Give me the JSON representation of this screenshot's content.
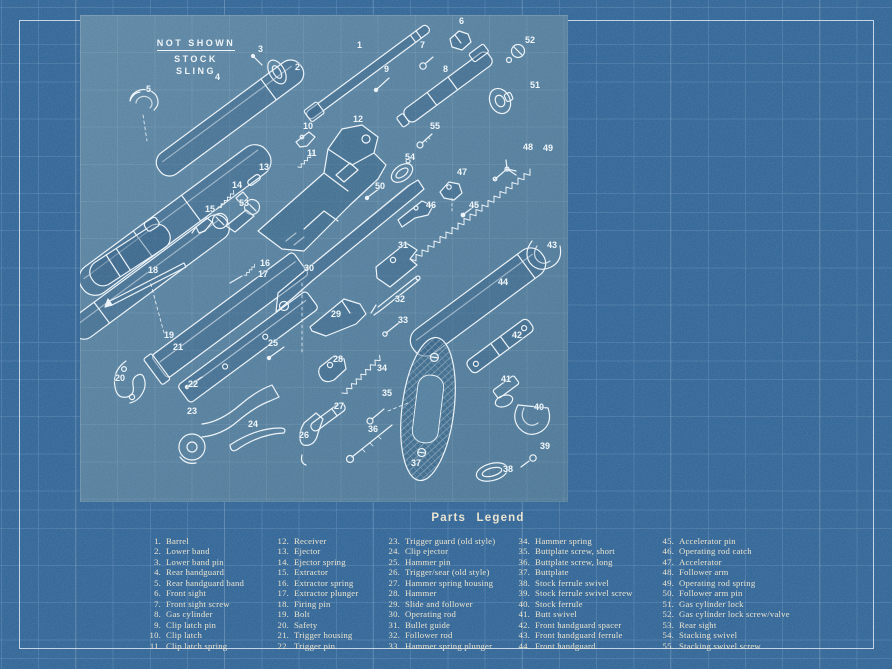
{
  "colors": {
    "background": "#2d6294",
    "panel": "#4f7c9c",
    "panel-shade": "#3c6e93",
    "ink": "#eae3cc",
    "line": "#ecf3f8",
    "frame": "#dce8f0"
  },
  "not_shown": {
    "heading": "NOT SHOWN",
    "line1": "STOCK",
    "line2": "SLING"
  },
  "legend": {
    "title": "Parts Legend",
    "items": [
      {
        "num": "1.",
        "name": "Barrel"
      },
      {
        "num": "2.",
        "name": "Lower band"
      },
      {
        "num": "3.",
        "name": "Lower band pin"
      },
      {
        "num": "4.",
        "name": "Rear handguard"
      },
      {
        "num": "5.",
        "name": "Rear handguard band"
      },
      {
        "num": "6.",
        "name": "Front sight"
      },
      {
        "num": "7.",
        "name": "Front sight screw"
      },
      {
        "num": "8.",
        "name": "Gas cylinder"
      },
      {
        "num": "9.",
        "name": "Clip latch pin"
      },
      {
        "num": "10.",
        "name": "Clip latch"
      },
      {
        "num": "11.",
        "name": "Clip latch spring"
      },
      {
        "num": "12.",
        "name": "Receiver"
      },
      {
        "num": "13.",
        "name": "Ejector"
      },
      {
        "num": "14.",
        "name": "Ejector spring"
      },
      {
        "num": "15.",
        "name": "Extractor"
      },
      {
        "num": "16.",
        "name": "Extractor spring"
      },
      {
        "num": "17.",
        "name": "Extractor plunger"
      },
      {
        "num": "18.",
        "name": "Firing pin"
      },
      {
        "num": "19.",
        "name": "Bolt"
      },
      {
        "num": "20.",
        "name": "Safety"
      },
      {
        "num": "21.",
        "name": "Trigger housing"
      },
      {
        "num": "22.",
        "name": "Trigger pin"
      },
      {
        "num": "23.",
        "name": "Trigger guard (old style)"
      },
      {
        "num": "24.",
        "name": "Clip ejector"
      },
      {
        "num": "25.",
        "name": "Hammer pin"
      },
      {
        "num": "26.",
        "name": "Trigger/sear (old style)"
      },
      {
        "num": "27.",
        "name": "Hammer spring housing"
      },
      {
        "num": "28.",
        "name": "Hammer"
      },
      {
        "num": "29.",
        "name": "Slide and follower"
      },
      {
        "num": "30.",
        "name": "Operating rod"
      },
      {
        "num": "31.",
        "name": "Bullet guide"
      },
      {
        "num": "32.",
        "name": "Follower rod"
      },
      {
        "num": "33.",
        "name": "Hammer spring plunger"
      },
      {
        "num": "34.",
        "name": "Hammer spring"
      },
      {
        "num": "35.",
        "name": "Buttplate screw, short"
      },
      {
        "num": "36.",
        "name": "Buttplate screw, long"
      },
      {
        "num": "37.",
        "name": "Buttplate"
      },
      {
        "num": "38.",
        "name": "Stock ferrule swivel"
      },
      {
        "num": "39.",
        "name": "Stock ferrule swivel screw"
      },
      {
        "num": "40.",
        "name": "Stock ferrule"
      },
      {
        "num": "41.",
        "name": "Butt swivel"
      },
      {
        "num": "42.",
        "name": "Front handguard spacer"
      },
      {
        "num": "43.",
        "name": "Front handguard ferrule"
      },
      {
        "num": "44.",
        "name": "Front handguard"
      },
      {
        "num": "45.",
        "name": "Accelerator pin"
      },
      {
        "num": "46.",
        "name": "Operating rod catch"
      },
      {
        "num": "47.",
        "name": "Accelerator"
      },
      {
        "num": "48.",
        "name": "Follower arm"
      },
      {
        "num": "49.",
        "name": "Operating rod spring"
      },
      {
        "num": "50.",
        "name": "Follower arm pin"
      },
      {
        "num": "51.",
        "name": "Gas cylinder lock"
      },
      {
        "num": "52.",
        "name": "Gas cylinder lock screw/valve"
      },
      {
        "num": "53.",
        "name": "Rear sight"
      },
      {
        "num": "54.",
        "name": "Stacking swivel"
      },
      {
        "num": "55.",
        "name": "Stacking swivel screw"
      }
    ]
  },
  "diagram": {
    "labels": [
      {
        "n": "1",
        "x": 277,
        "y": 33
      },
      {
        "n": "2",
        "x": 215,
        "y": 55
      },
      {
        "n": "3",
        "x": 178,
        "y": 37
      },
      {
        "n": "4",
        "x": 135,
        "y": 65
      },
      {
        "n": "5",
        "x": 66,
        "y": 77
      },
      {
        "n": "6",
        "x": 379,
        "y": 9
      },
      {
        "n": "7",
        "x": 340,
        "y": 33
      },
      {
        "n": "8",
        "x": 363,
        "y": 57
      },
      {
        "n": "9",
        "x": 304,
        "y": 57
      },
      {
        "n": "10",
        "x": 223,
        "y": 114
      },
      {
        "n": "11",
        "x": 227,
        "y": 141
      },
      {
        "n": "12",
        "x": 273,
        "y": 107
      },
      {
        "n": "13",
        "x": 179,
        "y": 155
      },
      {
        "n": "14",
        "x": 152,
        "y": 173
      },
      {
        "n": "15",
        "x": 125,
        "y": 197
      },
      {
        "n": "16",
        "x": 180,
        "y": 251
      },
      {
        "n": "17",
        "x": 178,
        "y": 262
      },
      {
        "n": "18",
        "x": 68,
        "y": 258
      },
      {
        "n": "19",
        "x": 84,
        "y": 323
      },
      {
        "n": "20",
        "x": 35,
        "y": 366
      },
      {
        "n": "21",
        "x": 93,
        "y": 335
      },
      {
        "n": "22",
        "x": 108,
        "y": 372
      },
      {
        "n": "23",
        "x": 107,
        "y": 399
      },
      {
        "n": "24",
        "x": 168,
        "y": 412
      },
      {
        "n": "25",
        "x": 188,
        "y": 331
      },
      {
        "n": "26",
        "x": 219,
        "y": 423
      },
      {
        "n": "27",
        "x": 254,
        "y": 394
      },
      {
        "n": "28",
        "x": 253,
        "y": 347
      },
      {
        "n": "29",
        "x": 251,
        "y": 302
      },
      {
        "n": "30",
        "x": 224,
        "y": 256
      },
      {
        "n": "31",
        "x": 318,
        "y": 233
      },
      {
        "n": "32",
        "x": 315,
        "y": 287
      },
      {
        "n": "33",
        "x": 318,
        "y": 308
      },
      {
        "n": "34",
        "x": 297,
        "y": 356
      },
      {
        "n": "35",
        "x": 302,
        "y": 381
      },
      {
        "n": "36",
        "x": 288,
        "y": 417
      },
      {
        "n": "37",
        "x": 331,
        "y": 451
      },
      {
        "n": "38",
        "x": 423,
        "y": 457
      },
      {
        "n": "39",
        "x": 460,
        "y": 434
      },
      {
        "n": "40",
        "x": 454,
        "y": 395
      },
      {
        "n": "41",
        "x": 421,
        "y": 367
      },
      {
        "n": "42",
        "x": 432,
        "y": 323
      },
      {
        "n": "43",
        "x": 467,
        "y": 233
      },
      {
        "n": "44",
        "x": 418,
        "y": 270
      },
      {
        "n": "45",
        "x": 389,
        "y": 193
      },
      {
        "n": "46",
        "x": 346,
        "y": 193
      },
      {
        "n": "47",
        "x": 377,
        "y": 160
      },
      {
        "n": "48",
        "x": 443,
        "y": 135
      },
      {
        "n": "49",
        "x": 463,
        "y": 136
      },
      {
        "n": "50",
        "x": 295,
        "y": 174
      },
      {
        "n": "51",
        "x": 450,
        "y": 73
      },
      {
        "n": "52",
        "x": 445,
        "y": 28
      },
      {
        "n": "53",
        "x": 159,
        "y": 191
      },
      {
        "n": "54",
        "x": 325,
        "y": 145
      },
      {
        "n": "55",
        "x": 350,
        "y": 114
      }
    ]
  }
}
